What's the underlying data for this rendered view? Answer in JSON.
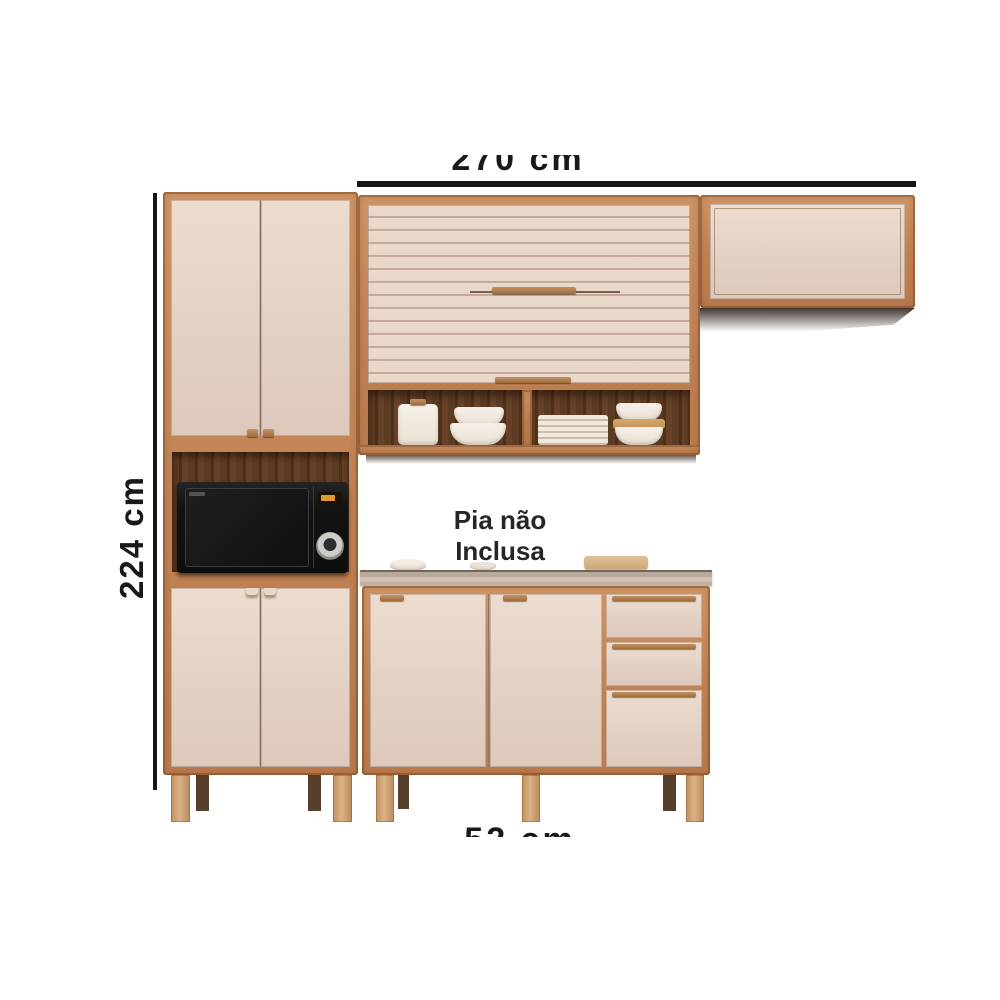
{
  "product": {
    "description": "kitchen cabinet set with microwave niche, roller-door wall cabinet, open shelf and counter cabinet"
  },
  "annotations": {
    "width": {
      "label": "270 cm"
    },
    "height": {
      "label": "224 cm"
    },
    "depth": {
      "label": "52 cm"
    },
    "note": {
      "line1": "Pia não",
      "line2": "Inclusa"
    }
  },
  "colors": {
    "background": "#ffffff",
    "dimension_line": "#161616",
    "text": "#191919",
    "wood_frame": "#c08153",
    "wood_handle": "#9c6c42",
    "door_cream": "#e3d1c5",
    "niche_interior": "#53341f",
    "countertop_surface": "#b8a99b",
    "countertop_edge": "#6f675d",
    "leg_wood": "#d0a377",
    "leg_back": "#57402b",
    "microwave_body": "#161616",
    "microwave_display": "#e09a33"
  }
}
